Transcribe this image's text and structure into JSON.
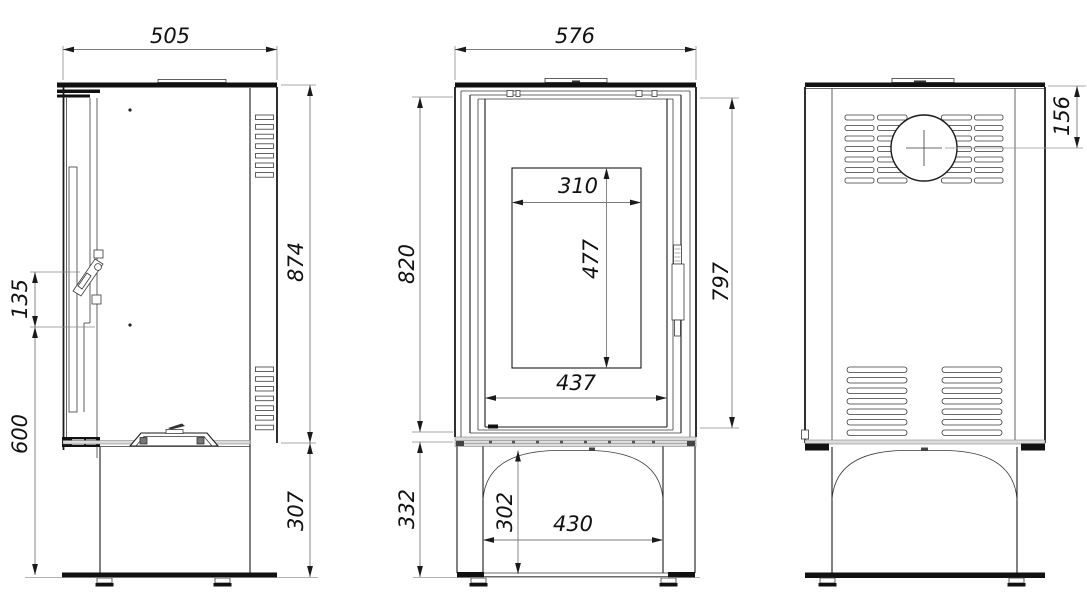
{
  "drawing": {
    "type": "stove-technical-drawing",
    "background": "#ffffff",
    "ink_color": "#1a1a1a",
    "dim_line_color": "#7a7a7a",
    "views": [
      "side",
      "front",
      "back"
    ]
  },
  "dimensions": {
    "side": {
      "depth": "505",
      "body_height": "874",
      "handle_span": "135",
      "handle_to_floor": "600",
      "base_height": "307"
    },
    "front": {
      "width": "576",
      "body_height": "820",
      "door_height": "797",
      "glass_width": "310",
      "glass_height": "477",
      "door_opening_width": "437",
      "base_height": "332",
      "base_clearance": "302",
      "base_opening_width": "430"
    },
    "back": {
      "flue_center_from_top": "156"
    }
  }
}
